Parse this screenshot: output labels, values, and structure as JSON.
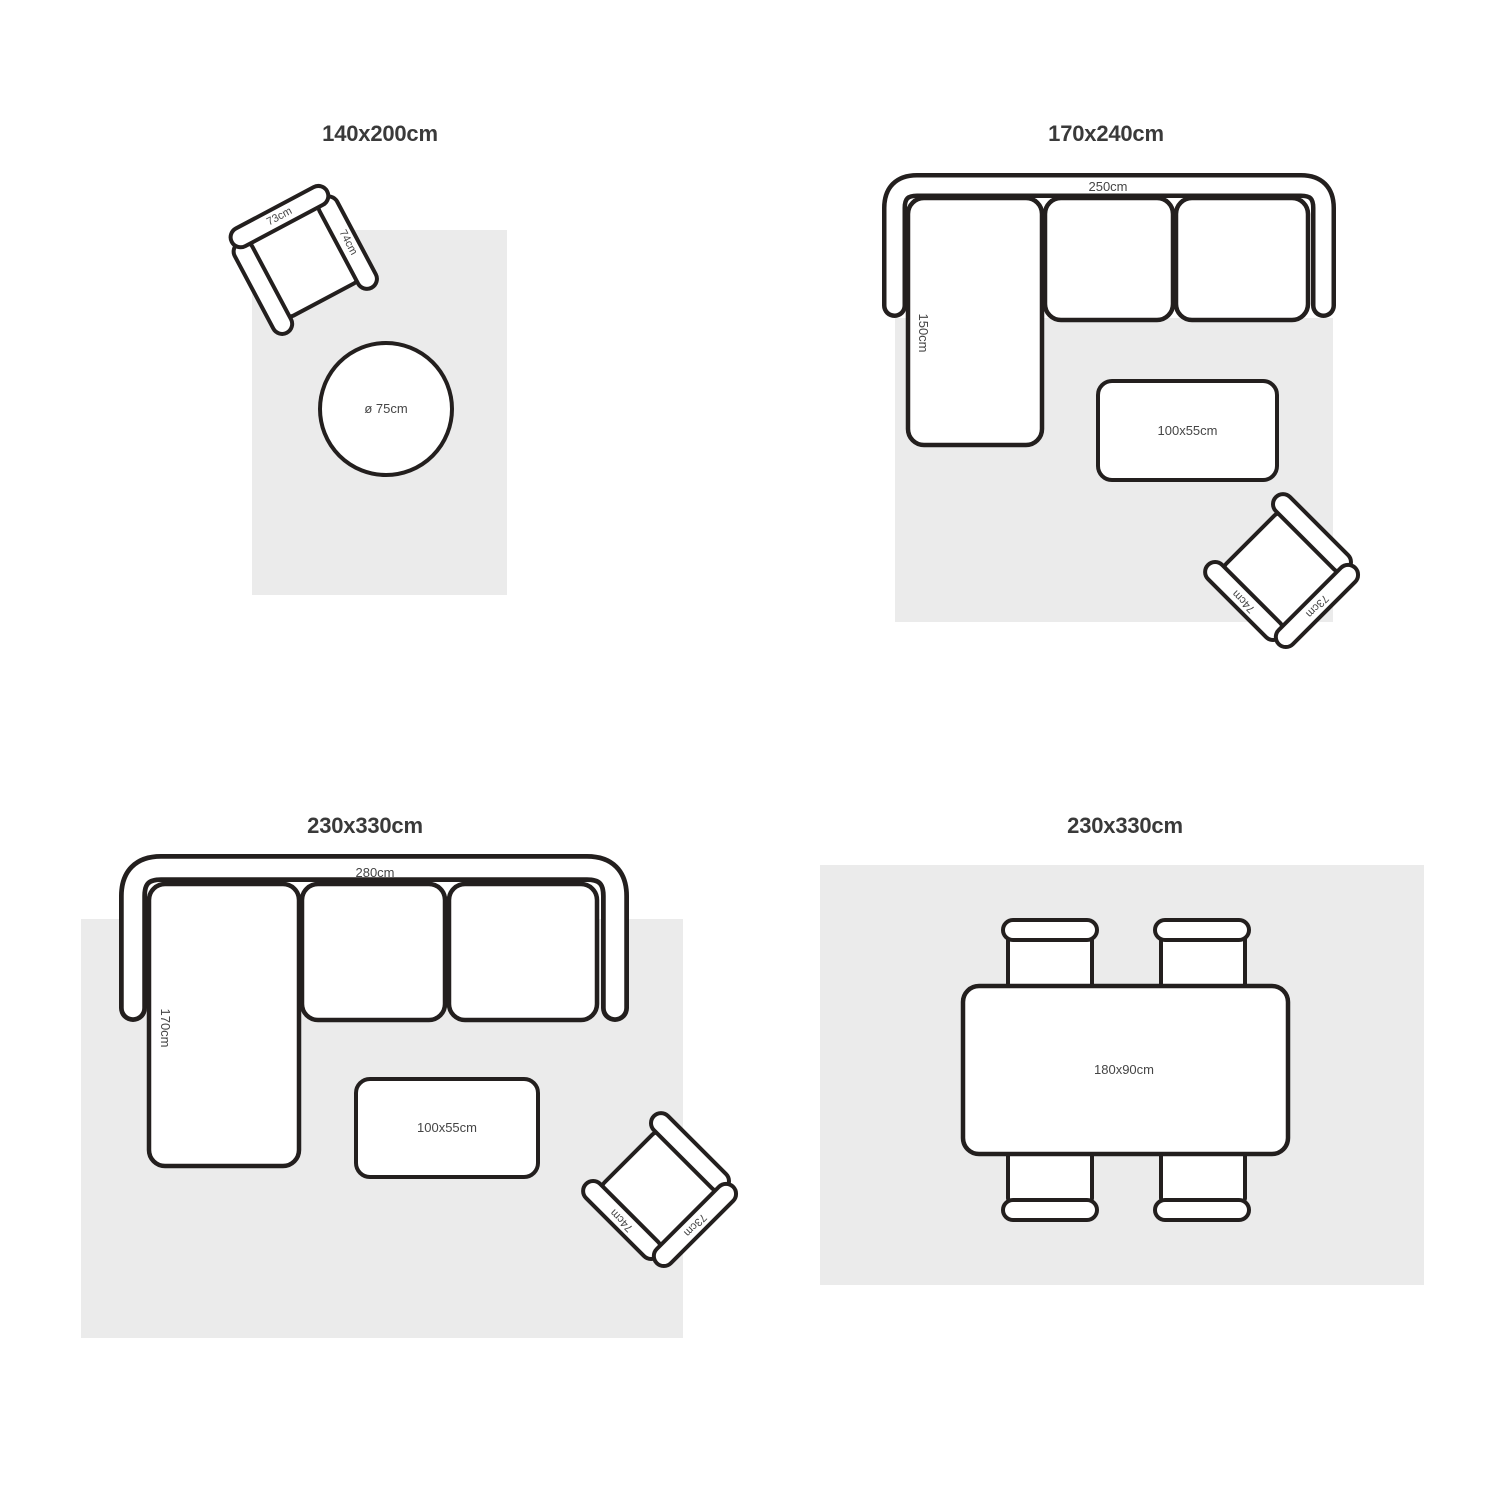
{
  "colors": {
    "background": "#ffffff",
    "rug_fill": "#ebebeb",
    "outline": "#231f1e",
    "title_text": "#3a3a3a",
    "dimension_text": "#454545"
  },
  "layouts": [
    {
      "title": "140x200cm",
      "armchair": {
        "back_label": "73cm",
        "arm_label": "74cm"
      },
      "round_table_label": "ø 75cm"
    },
    {
      "title": "170x240cm",
      "sofa": {
        "width_label": "250cm",
        "depth_label": "150cm"
      },
      "coffee_table_label": "100x55cm",
      "armchair": {
        "back_label": "73cm",
        "arm_label": "74cm"
      }
    },
    {
      "title": "230x330cm",
      "sofa": {
        "width_label": "280cm",
        "depth_label": "170cm"
      },
      "coffee_table_label": "100x55cm",
      "armchair": {
        "back_label": "73cm",
        "arm_label": "74cm"
      }
    },
    {
      "title": "230x330cm",
      "dining_table_label": "180x90cm"
    }
  ]
}
